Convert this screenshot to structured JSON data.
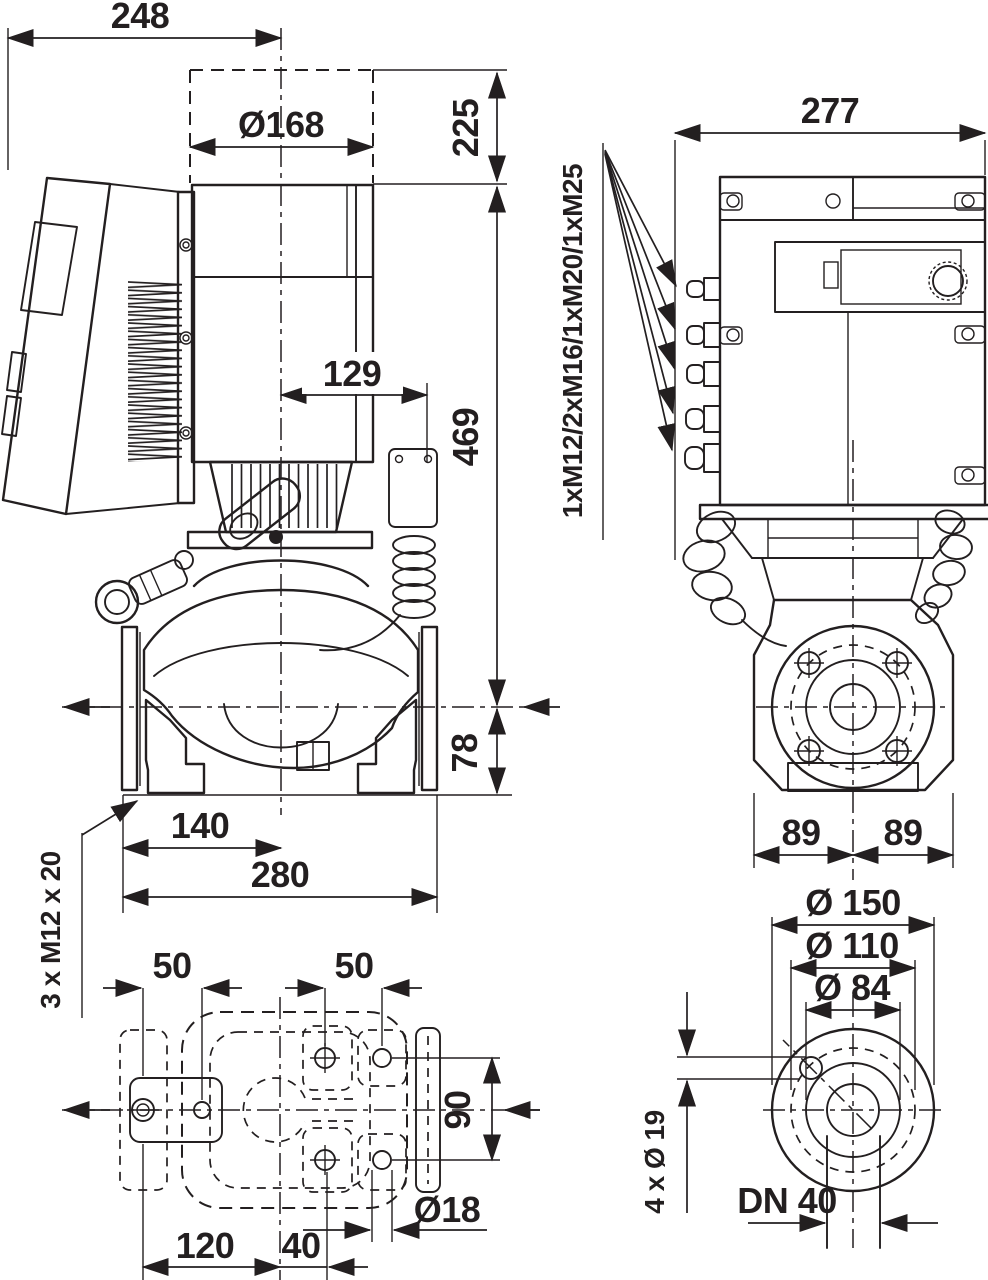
{
  "drawing": {
    "title": "pump-dimensional-drawing",
    "ink_color": "#231f20",
    "paper_color": "#ffffff",
    "dimensions": {
      "width_top": "248",
      "motor_diameter": "Ø168",
      "removal_clearance": "225",
      "center_to_module_side": "129",
      "axis_to_top": "469",
      "axis_to_base": "78",
      "axis_to_flange_face": "140",
      "port_to_port": "280",
      "foot_thread": "3 x M12 x 20",
      "depth": "277",
      "cable_glands": "1xM12/2xM16/1xM20/1xM25",
      "foot_left": "89",
      "foot_right": "89",
      "base_pitch_left": "50",
      "base_pitch_right": "50",
      "base_pitch_vertical": "90",
      "base_hole_diameter": "Ø18",
      "base_120": "120",
      "base_40": "40",
      "flange_outer_diameter": "Ø 150",
      "bolt_circle_diameter": "Ø 110",
      "raised_face_diameter": "Ø 84",
      "flange_holes": "4 x Ø 19",
      "nominal_diameter": "DN 40"
    }
  }
}
